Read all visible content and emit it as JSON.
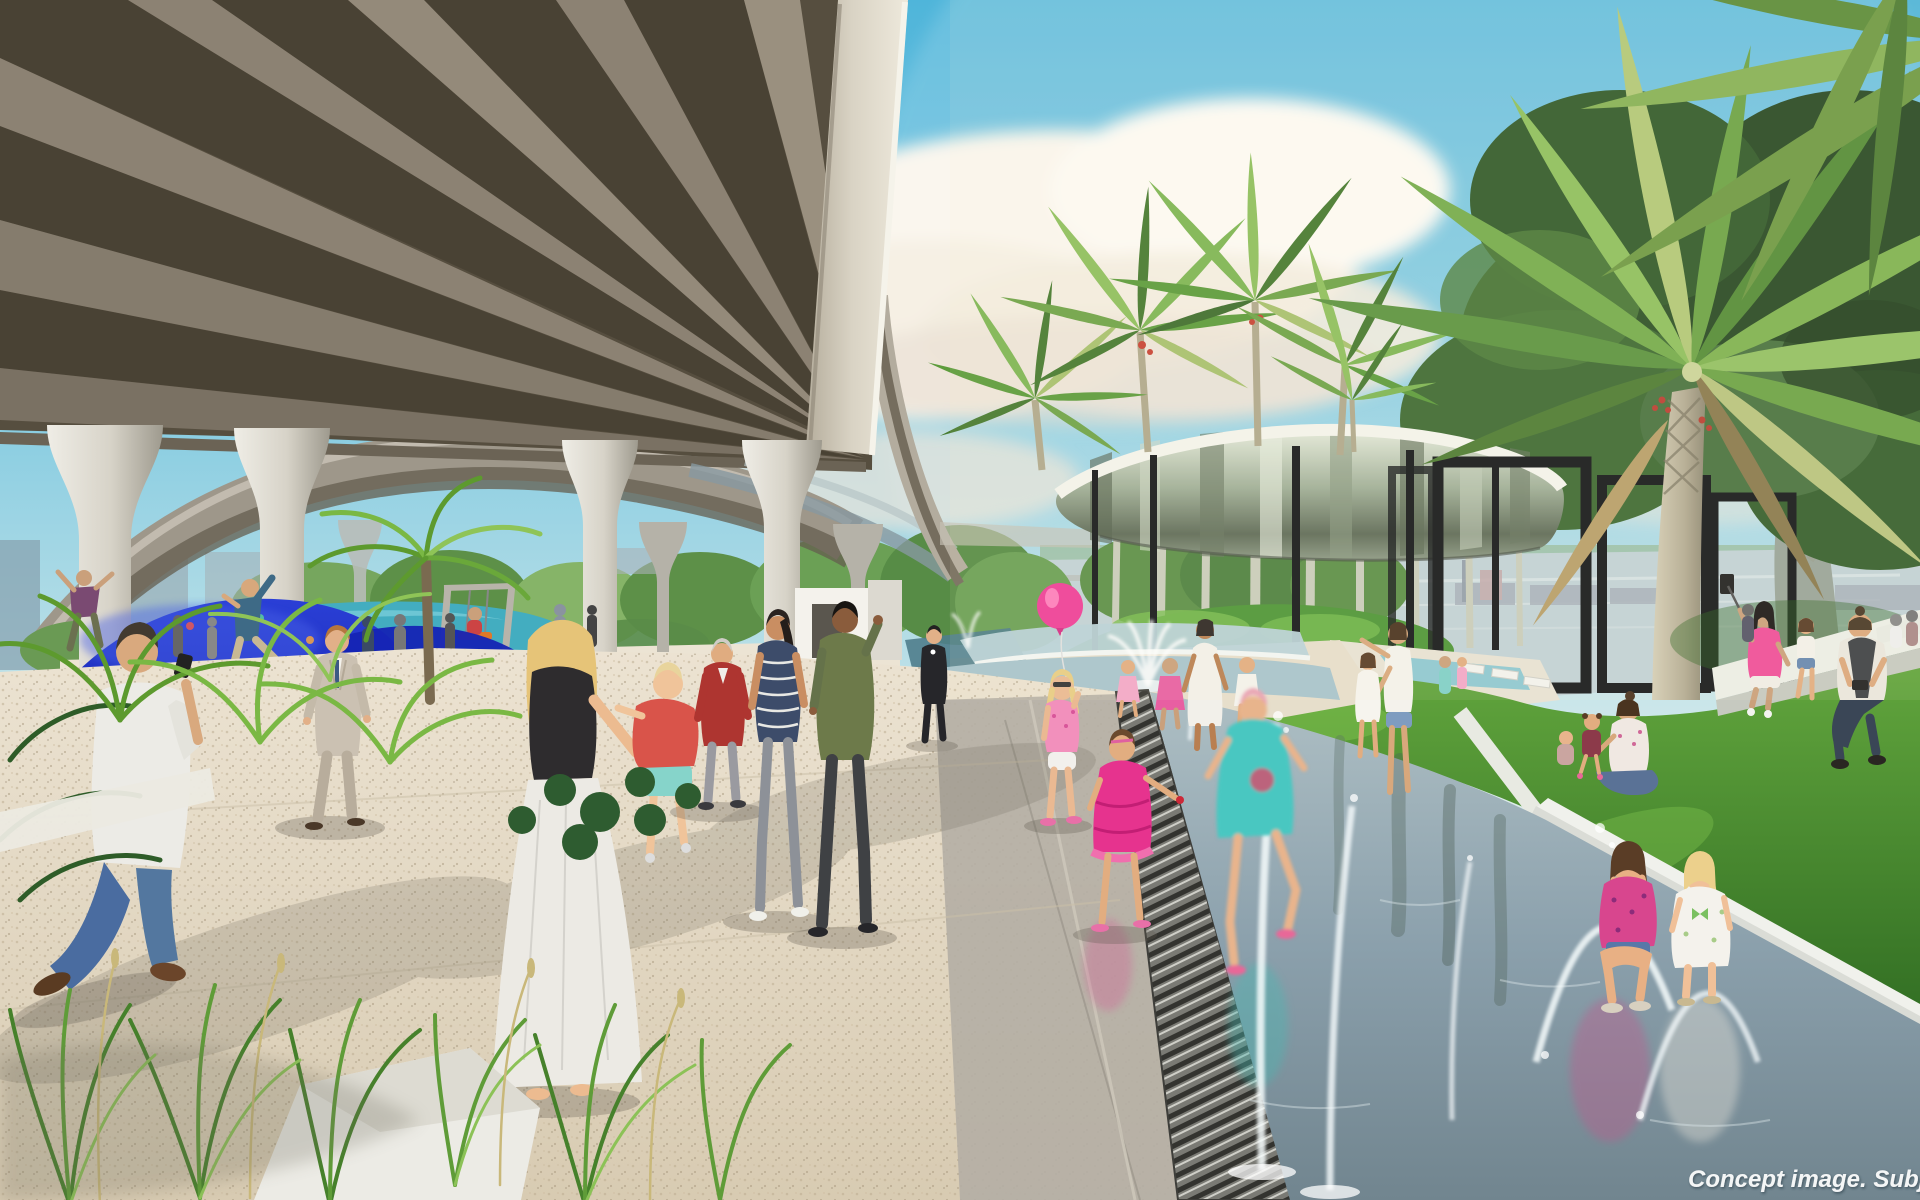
{
  "meta": {
    "type": "architectural concept rendering (photorealistic)",
    "scene": "Riverside park promenade beneath an elevated expressway: water-play fountains, lawns, palms, mirrored pavilion canopy, playground and pedestrians",
    "dimensions": "1920x1200"
  },
  "watermark": {
    "text": "Concept image. Subjec",
    "style": "white bold italic, bottom-right corner, cropped by image edge"
  },
  "palette": {
    "sky_top": "#4fb5da",
    "sky_horizon": "#efe6d2",
    "cloud": "#faf6ee",
    "overpass_soffit": "#564e3f",
    "overpass_beam": "#8c8273",
    "overpass_fascia": "#e6e1d4",
    "concrete_column": "#d9d5cb",
    "pavement": "#e4dac6",
    "pavement_shade": "#b4aea4",
    "grate_metal": "#73736d",
    "water_channel": "#8ba0ac",
    "pool_teal": "#43adc0",
    "playground_blue": "#1b2abe",
    "grass": "#4e9038",
    "foliage_dark": "#2f5229",
    "palm_green": "#6fa348",
    "canopy_chrome": "#98a78f",
    "steel_black": "#17191c",
    "river": "#c2d2d6",
    "balloon_pink": "#ee3f98",
    "dress_pink": "#e6338e",
    "dress_teal": "#4ac7c1",
    "jacket_red": "#ae3530",
    "suit_beige": "#cbc1b2"
  },
  "elements": [
    "elevated-expressway-soffit",
    "flared-concrete-columns",
    "loop-ramp",
    "blue-climbing-mound-playground",
    "swing",
    "tropical-ferns",
    "pedestrian-promenade",
    "walking-people",
    "mother-carrying-toddler",
    "pink-balloon-girl",
    "splash-pad-fountains",
    "running-children",
    "mirrored-pavilion-canopy",
    "black-pergola-frames",
    "palm-trees",
    "lawn-with-picnickers",
    "selfie-stick-woman",
    "river-and-city-skyline",
    "girls-sitting-at-water-edge",
    "drainage-grate",
    "concept-watermark"
  ]
}
